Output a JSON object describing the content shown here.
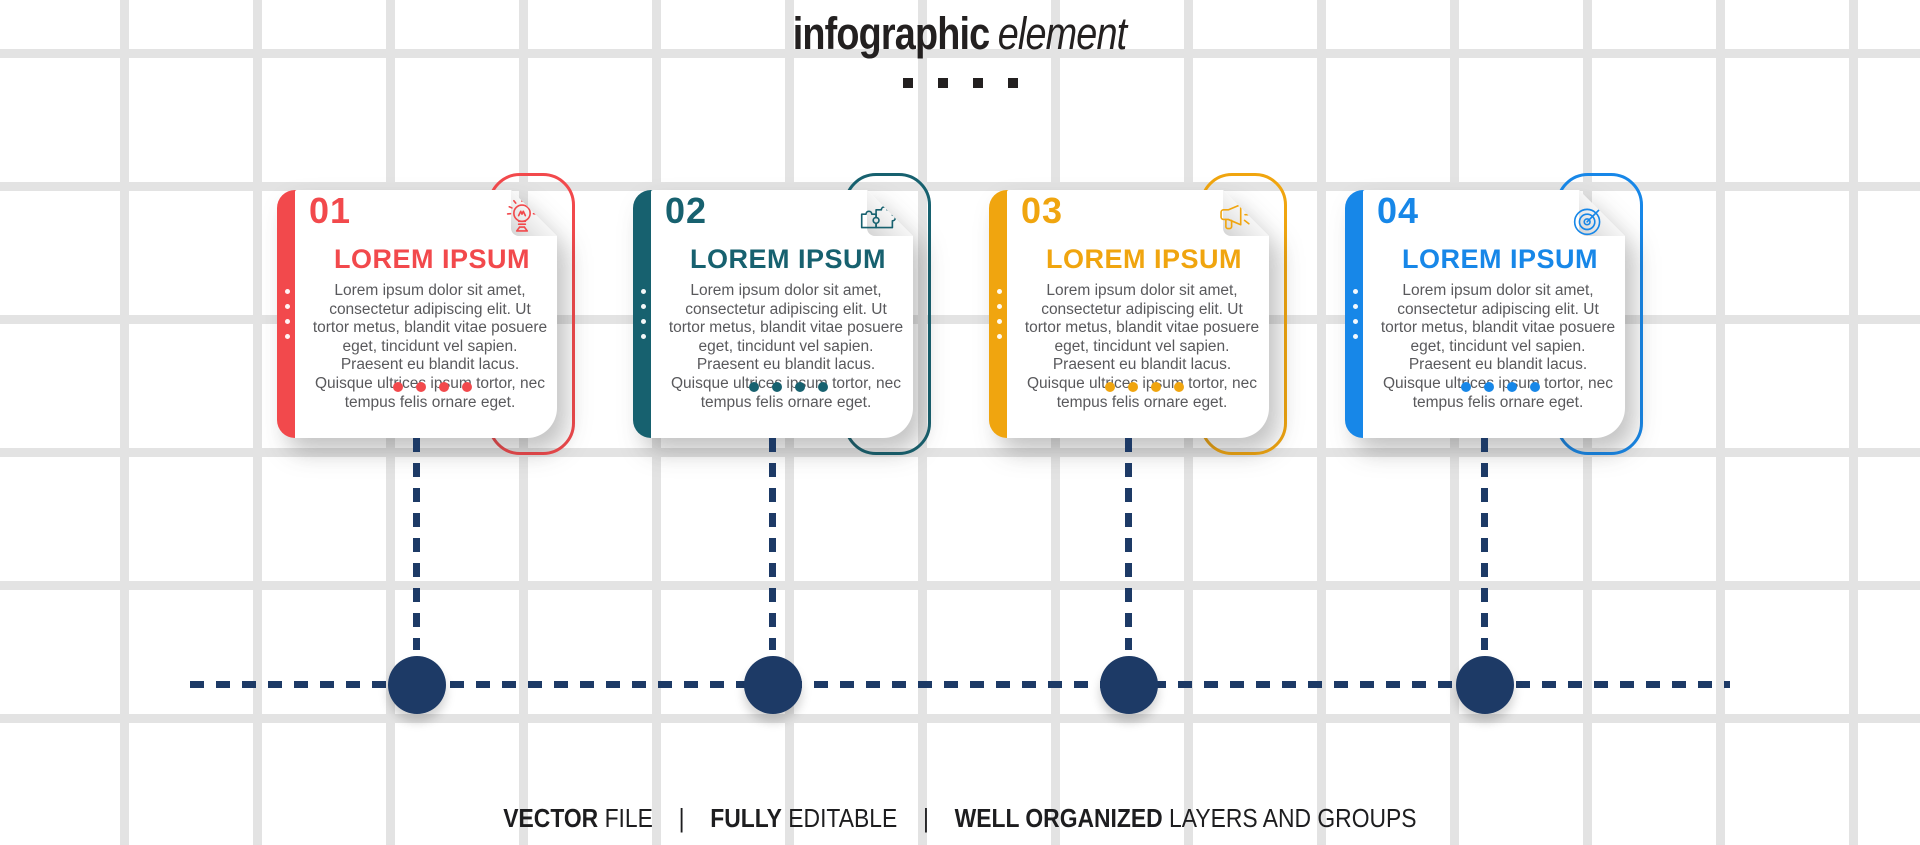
{
  "title": {
    "bold": "infographic",
    "italic": "element"
  },
  "decor": {
    "title_dots": 4,
    "bar_dots_per_card": 4,
    "bottom_dots_per_card": 4
  },
  "colors": {
    "navy": "#1d3a66",
    "grid_line": "#e3e3e3",
    "body_text": "#59595c",
    "heading_text": "#232020"
  },
  "cards": [
    {
      "number": "01",
      "color": "#f2494c",
      "icon": "lightbulb-icon",
      "heading": "LOREM IPSUM",
      "body": "Lorem ipsum dolor sit amet, consectetur adipiscing elit. Ut tortor metus, blandit vitae posuere eget, tincidunt vel sapien. Praesent eu blandit lacus. Quisque ultrices ipsum tortor, nec tempus felis ornare eget."
    },
    {
      "number": "02",
      "color": "#17616f",
      "icon": "puzzle-icon",
      "heading": "LOREM IPSUM",
      "body": "Lorem ipsum dolor sit amet, consectetur adipiscing elit. Ut tortor metus, blandit vitae posuere eget, tincidunt vel sapien. Praesent eu blandit lacus. Quisque ultrices ipsum tortor, nec tempus felis ornare eget."
    },
    {
      "number": "03",
      "color": "#f0a50f",
      "icon": "megaphone-icon",
      "heading": "LOREM IPSUM",
      "body": "Lorem ipsum dolor sit amet, consectetur adipiscing elit. Ut tortor metus, blandit vitae posuere eget, tincidunt vel sapien. Praesent eu blandit lacus. Quisque ultrices ipsum tortor, nec tempus felis ornare eget."
    },
    {
      "number": "04",
      "color": "#1787e8",
      "icon": "target-icon",
      "heading": "LOREM IPSUM",
      "body": "Lorem ipsum dolor sit amet, consectetur adipiscing elit. Ut tortor metus, blandit vitae posuere eget, tincidunt vel sapien. Praesent eu blandit lacus. Quisque ultrices ipsum tortor, nec tempus felis ornare eget."
    }
  ],
  "footer": {
    "separator": "|",
    "segments": [
      {
        "bold": "VECTOR",
        "regular": "FILE"
      },
      {
        "bold": "FULLY",
        "regular": "EDITABLE"
      },
      {
        "bold": "WELL ORGANIZED",
        "regular": "LAYERS AND GROUPS"
      }
    ]
  }
}
